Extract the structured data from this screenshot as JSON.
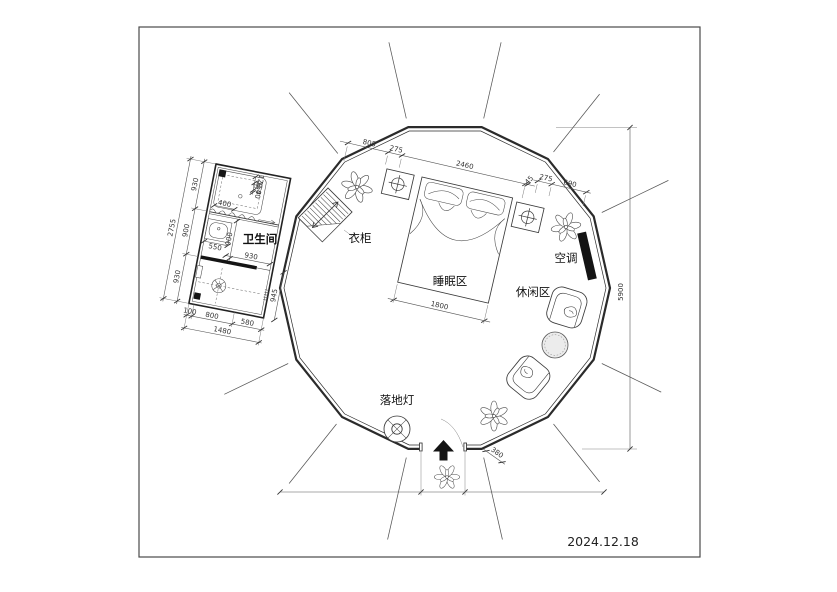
{
  "date": "2024.12.18",
  "labels": {
    "bathroom": "卫生间",
    "wardrobe": "衣柜",
    "sleeping_area": "睡眠区",
    "leisure_area": "休闲区",
    "air_conditioner": "空调",
    "floor_lamp": "落地灯"
  },
  "dimensions": {
    "room_height": "5900",
    "bed_width": "1800",
    "bed_span": "2460",
    "bed_wall_gap": "45",
    "top_left_segment": "805",
    "nightstand_left": "275",
    "nightstand_right": "275",
    "wall_right_segment": "690",
    "entry_side": "380",
    "bath_total_height": "2755",
    "bath_left_top": "930",
    "bath_left_mid": "900",
    "bath_left_bottom": "930",
    "bath_total_width": "1480",
    "bath_bottom_step": "100",
    "bath_bottom_left": "800",
    "bath_bottom_right": "580",
    "bath_right_lower": "945",
    "bath_inner_width": "930",
    "bath_inner_height": "900",
    "sink_width": "550",
    "shower_width": "400",
    "shower_side_a": "120",
    "shower_side_b": "150",
    "shower_side_c": "40"
  }
}
